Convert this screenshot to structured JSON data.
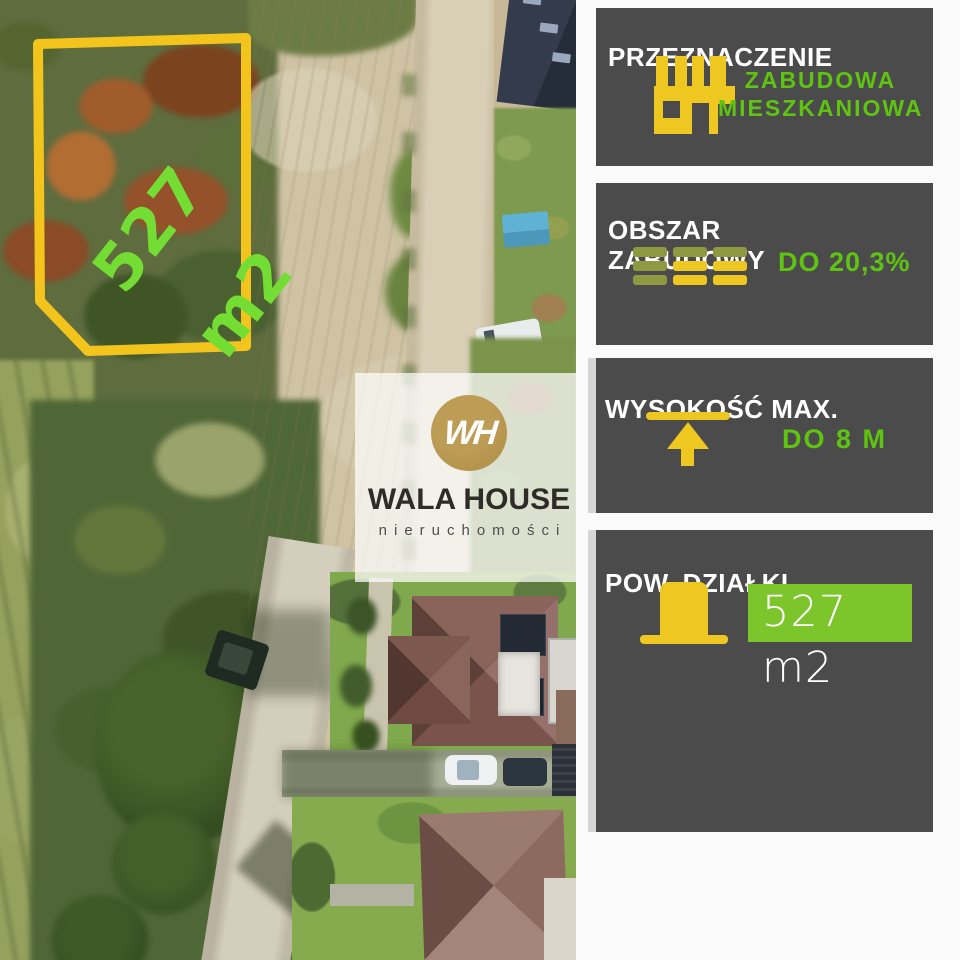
{
  "photo": {
    "plot_area_label": "527 m2"
  },
  "watermark": {
    "monogram": "WH",
    "brand": "WALA HOUSE",
    "tagline": "nieruchomości"
  },
  "panels": {
    "p1": {
      "title": "PRZEZNACZENIE",
      "icon": "building-icon",
      "value_line1": "ZABUDOWA",
      "value_line2": "MIESZKANIOWA"
    },
    "p2": {
      "title_line1": "OBSZAR",
      "title_line2": "ZABUDOWY",
      "icon": "coverage-bars-icon",
      "value": "DO 20,3%"
    },
    "p3": {
      "title": "WYSOKOŚĆ MAX.",
      "icon": "height-limit-icon",
      "value": "DO 8 M"
    },
    "p4": {
      "title": "POW. DZIAŁKI",
      "icon": "plot-area-icon",
      "value": "527 m2"
    }
  },
  "colors": {
    "panel_bg": "#4b4b4b",
    "title_white": "#ffffff",
    "accent_green": "#5fc312",
    "badge_green": "#7cc52b",
    "accent_yellow": "#eec720",
    "olive_bar": "#8d9a41",
    "plot_outline_yellow": "#f3c51c",
    "plot_label_green": "#74dd33",
    "logo_gold": "#b3924c"
  }
}
